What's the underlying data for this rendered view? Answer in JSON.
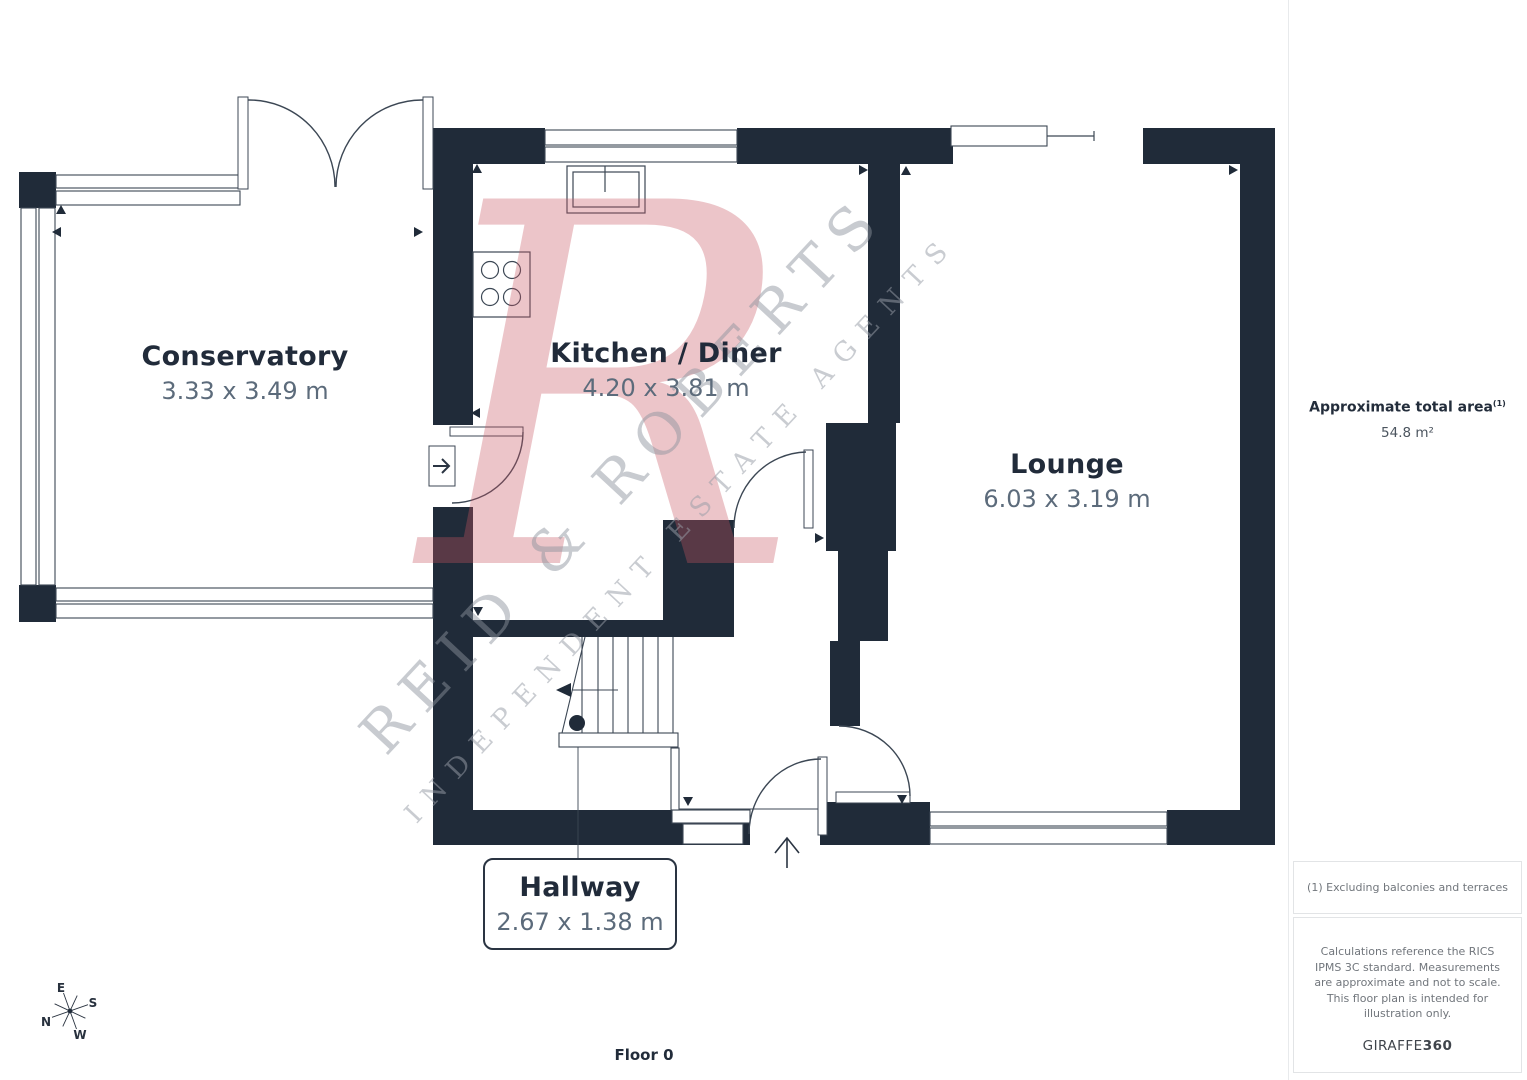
{
  "floorplan": {
    "rooms": [
      {
        "name": "Conservatory",
        "dims": "3.33 x 3.49 m"
      },
      {
        "name": "Kitchen / Diner",
        "dims": "4.20 x 3.81 m"
      },
      {
        "name": "Lounge",
        "dims": "6.03 x 3.19 m"
      },
      {
        "name": "Hallway",
        "dims": "2.67 x 1.38 m"
      }
    ],
    "floor_label": "Floor 0"
  },
  "compass": {
    "north": "N",
    "east": "E",
    "south": "S",
    "west": "W"
  },
  "watermark": {
    "monogram": "R",
    "line1": "REID & ROBERTS",
    "line2": "INDEPENDENT ESTATE AGENTS"
  },
  "sidebar": {
    "area_title": "Approximate total area",
    "area_footnote_marker": "(1)",
    "area_value": "54.8 m²",
    "note_exclusions": "(1) Excluding balconies and terraces",
    "note_disclaimer": "Calculations reference the RICS IPMS 3C standard. Measurements are approximate and not to scale. This floor plan is intended for illustration only.",
    "brand_name": "GIRAFFE",
    "brand_suffix": "360"
  },
  "colors": {
    "wall": "#202b39",
    "line": "#3c4754",
    "room_name": "#212b3a",
    "room_dims": "#5c6b7b",
    "watermark_red": "#c65460",
    "watermark_gray": "#8c939c"
  }
}
